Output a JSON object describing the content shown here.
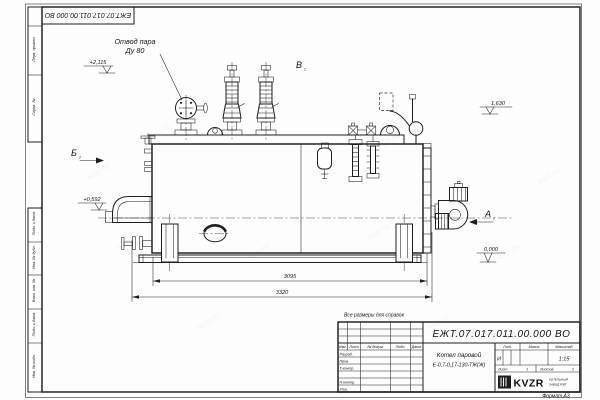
{
  "sheet": {
    "stamp_doc_number": "ЕЖТ.07.017.011.00.000  ВО",
    "reference_note": "Все размеры для справок",
    "format_label": "Формат А3",
    "watermark_text": "kvzr.ru"
  },
  "margin_labels": {
    "perv_primen": "Перв. примен.",
    "sprav_no": "Справ. №",
    "podp_data_1": "Подп. и дата",
    "inv_dubl": "Инв. № дубл.",
    "vzam_inv": "Взам. инв. №",
    "podp_data_2": "Подп. и дата",
    "inv_podl": "Инв. № подл."
  },
  "annotations": {
    "steam_outlet_label_line1": "Отвод пара",
    "steam_outlet_label_line2": "Ду 80",
    "elev_steam": "+2,115",
    "elev_burner": "+0,592",
    "elev_top": "1,630",
    "elev_ground": "0,000",
    "dim_inner": "3095",
    "dim_overall": "3320",
    "view_a": "А",
    "view_b": "Б",
    "view_v": "В",
    "view_sheet_ref": "2"
  },
  "title_block": {
    "doc_number": "ЕЖТ.07.017.011.00.000  ВО",
    "product_name": "Котел паровой",
    "product_model": "Е-0,7-0,17-130-ТЖ(Ж)",
    "columns": {
      "izm": "Изм.",
      "list": "Лист",
      "dokum": "№ докум.",
      "podp": "Подп.",
      "data": "Дата"
    },
    "rows": {
      "razrab": "Разраб.",
      "prov": "Пров.",
      "tkontr": "Т.контр.",
      "nkontr": "Н.контр.",
      "utv": "Утв."
    },
    "lit_label": "Лит.",
    "lit_value": "И",
    "massa_label": "Масса",
    "masshtab_label": "Масштаб",
    "scale": "1:15",
    "list_label": "Лист",
    "list_value": "1",
    "listov_label": "Листов",
    "listov_value": "2",
    "company": "KVZR",
    "company_sub1": "КОТЕЛЬНЫЙ",
    "company_sub2": "ЗАВОД РЭП"
  }
}
